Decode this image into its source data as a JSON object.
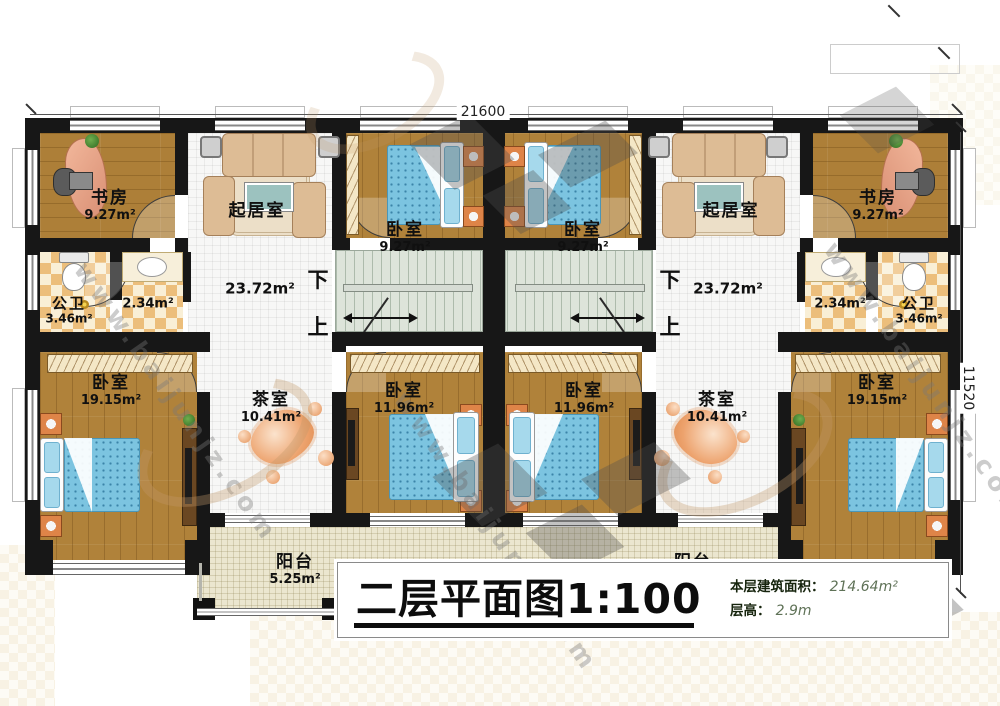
{
  "plan": {
    "drawing_name": "二层平面图",
    "scale": "1:100"
  },
  "dimensions": {
    "top_width": "21600",
    "right_height": "11520"
  },
  "stairs": {
    "down": "下",
    "up": "上"
  },
  "rooms": {
    "study": {
      "name": "书房",
      "area": "9.27m²"
    },
    "living": {
      "name": "起居室",
      "area": "23.72m²"
    },
    "bedroom_small": {
      "name": "卧室",
      "area": "9.27m²"
    },
    "bath": {
      "name": "公卫",
      "area": "3.46m²"
    },
    "wash": {
      "area": "2.34m²"
    },
    "bedroom_large": {
      "name": "卧室",
      "area": "19.15m²"
    },
    "tea_room": {
      "name": "茶室",
      "area": "10.41m²"
    },
    "bedroom_mid": {
      "name": "卧室",
      "area": "11.96m²"
    },
    "balcony": {
      "name": "阳台",
      "area": "5.25m²"
    }
  },
  "title_block": {
    "title": "二层平面图1:100",
    "floor_area_label": "本层建筑面积：",
    "floor_area_value": "214.64m²",
    "floor_height_label": "层高：",
    "floor_height_value": "2.9m"
  },
  "watermark": {
    "site": "www.baijunjz.com"
  }
}
